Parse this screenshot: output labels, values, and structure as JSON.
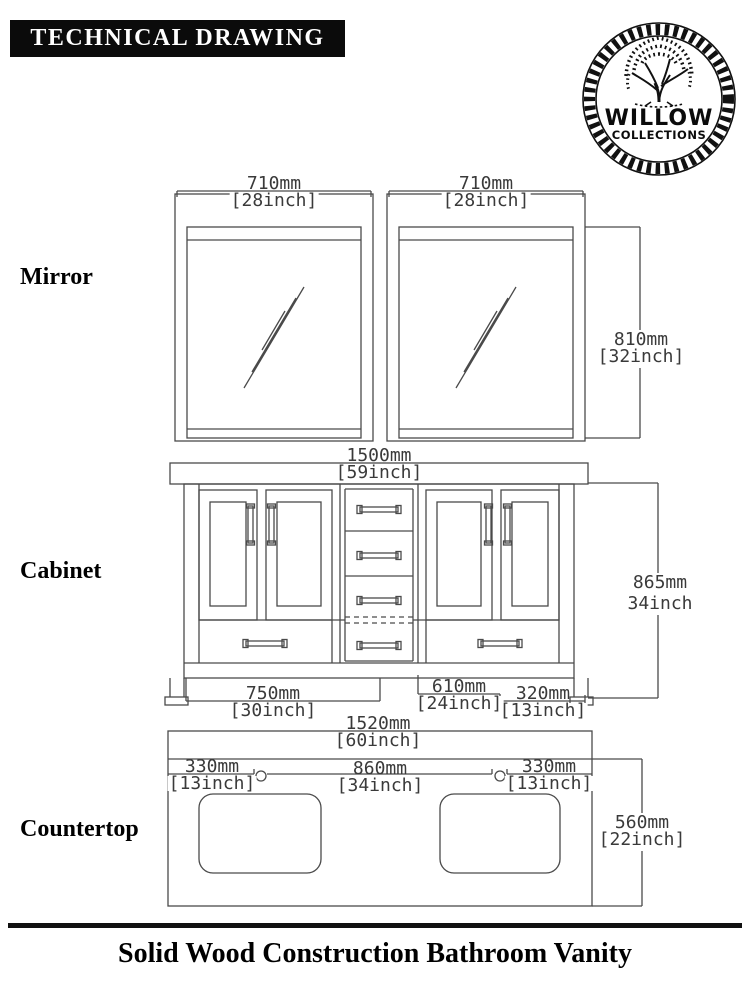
{
  "header": {
    "title": "TECHNICAL DRAWING"
  },
  "logo": {
    "brand": "WILLOW",
    "subtitle": "COLLECTIONS"
  },
  "sections": {
    "mirror": {
      "label": "Mirror",
      "dims": {
        "left_width": {
          "mm": "710mm",
          "inch": "[28inch]"
        },
        "right_width": {
          "mm": "710mm",
          "inch": "[28inch]"
        },
        "height": {
          "mm": "810mm",
          "inch": "[32inch]"
        }
      }
    },
    "cabinet": {
      "label": "Cabinet",
      "dims": {
        "width": {
          "mm": "1500mm",
          "inch": "[59inch]"
        },
        "height": {
          "mm": "865mm",
          "inch": "34inch"
        },
        "base_left": {
          "mm": "750mm",
          "inch": "[30inch]"
        },
        "base_center": {
          "mm": "610mm",
          "inch": "[24inch]"
        },
        "base_right": {
          "mm": "320mm",
          "inch": "[13inch]"
        }
      }
    },
    "countertop": {
      "label": "Countertop",
      "dims": {
        "width": {
          "mm": "1520mm",
          "inch": "[60inch]"
        },
        "left_offset": {
          "mm": "330mm",
          "inch": "[13inch]"
        },
        "faucet_span": {
          "mm": "860mm",
          "inch": "[34inch]"
        },
        "right_offset": {
          "mm": "330mm",
          "inch": "[13inch]"
        },
        "depth": {
          "mm": "560mm",
          "inch": "[22inch]"
        }
      }
    }
  },
  "footer": {
    "title": "Solid Wood Construction Bathroom Vanity"
  },
  "colors": {
    "drawing_line": "#4a4a4a",
    "dimension_text": "#3a3a3a",
    "ink": "#000000",
    "background": "#ffffff"
  }
}
